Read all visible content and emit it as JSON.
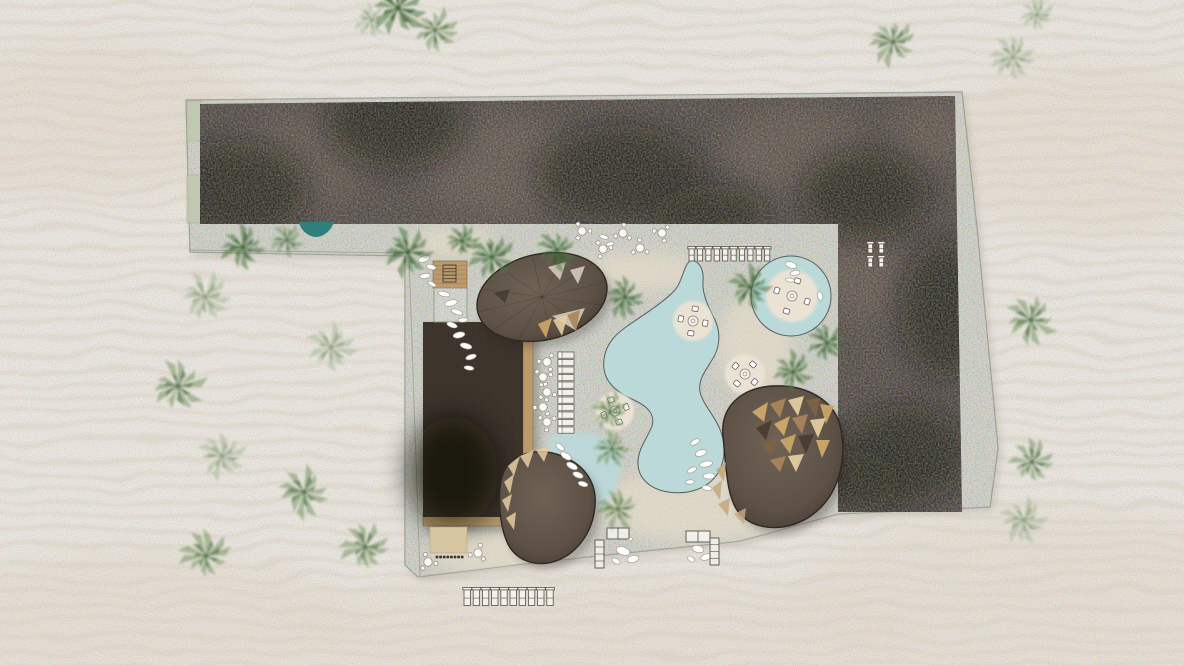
{
  "plan": {
    "canvas": {
      "w": 1184,
      "h": 666
    },
    "colors": {
      "sand": "#f3eee6",
      "sand_line": "#e4d8c6",
      "sand_shade": "#ece1d2",
      "plaza": "#d5d7c8",
      "plaza_edge": "#989c8d",
      "plaza_dune": "#eadfcb",
      "roof": "#3d342c",
      "roof_light": "#6a594a",
      "roof_black": "#0a0705",
      "pool": "#bcd9da",
      "pool_stroke": "#565f5c",
      "teal_pool": "#2f807d",
      "island": "#eae2d3",
      "white": "#ffffff",
      "furniture_stroke": "#57524b",
      "wood": "#bb9a6b",
      "wood_dark": "#8a6e4b",
      "dome": "#63564a",
      "dome_oval": "#6b5e52",
      "dome_stroke": "#2f2822",
      "tan_a": "#cfa96b",
      "tan_b": "#e3cc9f",
      "tan_c": "#a9855a",
      "tan_d": "#7c6347",
      "patch": "#d5c5a0",
      "planter": "#bfc9ae",
      "pebble": "#fdfdfb",
      "pebble_stroke": "#9a958c",
      "pale_tri": "#d3ccbd",
      "shadow": "#8d8673"
    },
    "site": {
      "outline": [
        [
          186,
          100
        ],
        [
          962,
          92
        ],
        [
          977,
          228
        ],
        [
          998,
          448
        ],
        [
          990,
          507
        ],
        [
          838,
          514
        ],
        [
          740,
          541
        ],
        [
          530,
          563
        ],
        [
          418,
          577
        ],
        [
          405,
          565
        ],
        [
          405,
          256
        ],
        [
          190,
          252
        ]
      ],
      "roof_top": [
        [
          200,
          104
        ],
        [
          955,
          96
        ],
        [
          957,
          224
        ],
        [
          200,
          224
        ]
      ],
      "roof_right": [
        [
          838,
          224
        ],
        [
          957,
          224
        ],
        [
          962,
          512
        ],
        [
          838,
          512
        ]
      ],
      "roof_dark_blobs": [
        [
          235,
          190,
          75,
          50
        ],
        [
          395,
          125,
          70,
          45
        ],
        [
          620,
          175,
          85,
          50
        ],
        [
          710,
          215,
          60,
          30
        ],
        [
          865,
          195,
          65,
          45
        ],
        [
          945,
          310,
          45,
          70
        ],
        [
          905,
          455,
          65,
          50
        ],
        [
          850,
          482,
          50,
          32
        ]
      ],
      "roof_light_patches": [
        [
          300,
          160,
          70,
          45
        ],
        [
          500,
          165,
          80,
          50
        ],
        [
          795,
          150,
          70,
          45
        ],
        [
          935,
          135,
          45,
          35
        ],
        [
          862,
          272,
          45,
          50
        ]
      ],
      "planters": [
        [
          187,
          101,
          14,
          40
        ],
        [
          187,
          175,
          16,
          48
        ]
      ],
      "inner_lines": [
        [
          [
            190,
            250
          ],
          [
            408,
            253
          ]
        ],
        [
          [
            409,
            256
          ],
          [
            420,
            576
          ]
        ]
      ],
      "plaza_dunes": [
        [
          640,
          272,
          60,
          20
        ],
        [
          755,
          345,
          38,
          48
        ],
        [
          700,
          505,
          100,
          38
        ],
        [
          505,
          552,
          75,
          26
        ],
        [
          452,
          242,
          40,
          14
        ]
      ]
    },
    "pools": {
      "freeform_path": "M 692,260 C 700,262 704,270 703,281 C 702,294 708,306 715,320 C 721,333 720,348 712,360 C 705,371 698,380 700,392 C 703,404 713,414 719,427 C 726,442 726,460 718,473 C 708,489 688,495 668,492 C 649,489 637,477 638,461 C 639,447 648,437 652,426 C 655,416 650,408 636,401 C 618,393 606,384 604,369 C 602,352 610,338 626,327 C 643,315 663,303 675,290 C 683,281 684,262 692,260 Z",
      "lagoon_path": "M 552,434 C 572,428 596,432 610,443 C 622,453 624,468 618,480 C 612,493 612,502 602,506 C 588,511 570,501 560,490 C 549,478 544,462 548,450 C 550,443 548,437 552,434 Z",
      "teal_path": "M 299,222 C 301,232 310,237 316,237 C 323,237 331,231 334,222 Z",
      "circular": {
        "cx": 791,
        "cy": 296,
        "r": 40
      }
    },
    "islands": [
      [
        693,
        321,
        20,
        10
      ],
      [
        745,
        374,
        20,
        40
      ],
      [
        615,
        411,
        19,
        70
      ],
      [
        792,
        296,
        26,
        20
      ]
    ],
    "building": {
      "x": 423,
      "y": 322,
      "w": 100,
      "h": 195,
      "wood_right": [
        523,
        322,
        10,
        195
      ],
      "wood_bottom": [
        423,
        513,
        110,
        13
      ],
      "tan_patch": [
        430,
        527,
        37,
        26
      ]
    },
    "deck": {
      "wood": [
        433,
        261,
        34,
        27
      ],
      "ladder": [
        443,
        265,
        13,
        17
      ],
      "box": [
        434,
        288,
        33,
        34
      ]
    },
    "domes": {
      "oval": {
        "cx": 542,
        "cy": 297,
        "rx": 66,
        "ry": 43,
        "rot": -13
      },
      "oval_facets": [
        {
          "pts": [
            [
              548,
              267
            ],
            [
              566,
              262
            ],
            [
              560,
              280
            ]
          ],
          "c": "pale"
        },
        {
          "pts": [
            [
              570,
              270
            ],
            [
              585,
              266
            ],
            [
              578,
              284
            ]
          ],
          "c": "pale"
        },
        {
          "pts": [
            [
              494,
              293
            ],
            [
              510,
              289
            ],
            [
              505,
              303
            ]
          ],
          "c": "dark"
        },
        {
          "pts": [
            [
              552,
              316
            ],
            [
              585,
              308
            ],
            [
              575,
              330
            ]
          ],
          "c": "pale"
        },
        {
          "pts": [
            [
              538,
              324
            ],
            [
              552,
              318
            ],
            [
              546,
              338
            ]
          ],
          "c": "tan_a"
        },
        {
          "pts": [
            [
              553,
              320
            ],
            [
              568,
              314
            ],
            [
              562,
              336
            ]
          ],
          "c": "tan_b"
        },
        {
          "pts": [
            [
              567,
              315
            ],
            [
              580,
              310
            ],
            [
              576,
              332
            ]
          ],
          "c": "tan_c"
        }
      ],
      "right_path": "M 723,436 C 720,406 742,388 772,386 C 806,384 836,400 841,430 C 847,462 838,496 812,515 C 790,531 759,532 742,516 C 726,502 726,464 723,436 Z",
      "right_mosaic": [
        [
          [
            752,
            412
          ],
          [
            768,
            402
          ],
          [
            764,
            422
          ]
        ],
        [
          [
            770,
            404
          ],
          [
            786,
            398
          ],
          [
            780,
            418
          ]
        ],
        [
          [
            788,
            400
          ],
          [
            804,
            396
          ],
          [
            798,
            416
          ]
        ],
        [
          [
            806,
            400
          ],
          [
            820,
            398
          ],
          [
            816,
            418
          ]
        ],
        [
          [
            820,
            404
          ],
          [
            834,
            406
          ],
          [
            826,
            424
          ]
        ],
        [
          [
            756,
            428
          ],
          [
            772,
            420
          ],
          [
            766,
            440
          ]
        ],
        [
          [
            774,
            424
          ],
          [
            790,
            416
          ],
          [
            784,
            436
          ]
        ],
        [
          [
            792,
            418
          ],
          [
            808,
            414
          ],
          [
            802,
            434
          ]
        ],
        [
          [
            810,
            420
          ],
          [
            826,
            418
          ],
          [
            818,
            438
          ]
        ],
        [
          [
            762,
            444
          ],
          [
            778,
            438
          ],
          [
            772,
            456
          ]
        ],
        [
          [
            780,
            440
          ],
          [
            796,
            434
          ],
          [
            790,
            454
          ]
        ],
        [
          [
            798,
            436
          ],
          [
            814,
            434
          ],
          [
            806,
            454
          ]
        ],
        [
          [
            816,
            440
          ],
          [
            830,
            440
          ],
          [
            822,
            458
          ]
        ],
        [
          [
            770,
            460
          ],
          [
            786,
            456
          ],
          [
            780,
            472
          ]
        ],
        [
          [
            788,
            456
          ],
          [
            804,
            454
          ],
          [
            796,
            472
          ]
        ]
      ],
      "right_rim": [
        [
          [
            716,
            470
          ],
          [
            726,
            462
          ],
          [
            724,
            482
          ]
        ],
        [
          [
            712,
            488
          ],
          [
            722,
            480
          ],
          [
            720,
            500
          ]
        ],
        [
          [
            718,
            504
          ],
          [
            730,
            498
          ],
          [
            728,
            516
          ]
        ],
        [
          [
            734,
            514
          ],
          [
            746,
            508
          ],
          [
            744,
            524
          ]
        ]
      ],
      "bottom_path": "M 505,469 C 515,452 540,447 562,456 C 585,465 597,483 595,506 C 593,531 578,553 556,561 C 535,568 515,560 507,542 C 499,523 496,487 505,469 Z",
      "bottom_rim": [
        [
          [
            508,
            466
          ],
          [
            520,
            456
          ],
          [
            514,
            476
          ]
        ],
        [
          [
            504,
            482
          ],
          [
            514,
            474
          ],
          [
            510,
            494
          ]
        ],
        [
          [
            502,
            500
          ],
          [
            512,
            494
          ],
          [
            508,
            512
          ]
        ],
        [
          [
            506,
            518
          ],
          [
            516,
            512
          ],
          [
            514,
            530
          ]
        ],
        [
          [
            520,
            456
          ],
          [
            534,
            450
          ],
          [
            528,
            468
          ]
        ],
        [
          [
            536,
            450
          ],
          [
            550,
            446
          ],
          [
            544,
            462
          ]
        ]
      ]
    },
    "palms": [
      [
        398,
        8,
        28,
        "d"
      ],
      [
        435,
        30,
        22,
        "m"
      ],
      [
        372,
        20,
        18,
        "p"
      ],
      [
        893,
        42,
        24,
        "m"
      ],
      [
        1013,
        57,
        22,
        "p"
      ],
      [
        1037,
        15,
        18,
        "p"
      ],
      [
        205,
        297,
        26,
        "p"
      ],
      [
        178,
        386,
        27,
        "m"
      ],
      [
        331,
        347,
        25,
        "p"
      ],
      [
        222,
        456,
        25,
        "p"
      ],
      [
        304,
        492,
        26,
        "m"
      ],
      [
        365,
        547,
        25,
        "m"
      ],
      [
        206,
        556,
        25,
        "m"
      ],
      [
        1031,
        320,
        26,
        "m"
      ],
      [
        1032,
        462,
        22,
        "m"
      ],
      [
        1024,
        520,
        24,
        "p"
      ],
      [
        243,
        247,
        23,
        "d"
      ],
      [
        287,
        240,
        17,
        "m"
      ],
      [
        408,
        252,
        25,
        "d"
      ],
      [
        462,
        241,
        17,
        "d"
      ],
      [
        492,
        257,
        23,
        "d"
      ],
      [
        557,
        250,
        21,
        "d"
      ],
      [
        625,
        297,
        21,
        "d"
      ],
      [
        750,
        287,
        22,
        "d"
      ],
      [
        793,
        372,
        21,
        "d"
      ],
      [
        827,
        343,
        19,
        "d"
      ],
      [
        610,
        412,
        20,
        "m"
      ],
      [
        612,
        449,
        19,
        "m"
      ],
      [
        618,
        509,
        21,
        "m"
      ]
    ],
    "pebbles": [
      [
        424,
        259,
        6,
        3,
        -20
      ],
      [
        431,
        267,
        5,
        2.5,
        15
      ],
      [
        425,
        276,
        5.5,
        2.5,
        -8
      ],
      [
        432,
        284,
        4.5,
        2,
        30
      ],
      [
        444,
        294,
        6,
        2.5,
        12
      ],
      [
        451,
        303,
        6.5,
        3,
        -14
      ],
      [
        457,
        312,
        6,
        2.5,
        18
      ],
      [
        463,
        320,
        5,
        2.2,
        -5
      ],
      [
        452,
        325,
        5.5,
        2.5,
        20
      ],
      [
        459,
        335,
        6,
        3,
        -12
      ],
      [
        466,
        346,
        6,
        2.8,
        15
      ],
      [
        471,
        357,
        5.5,
        2.5,
        -18
      ],
      [
        469,
        368,
        5,
        2.2,
        8
      ],
      [
        560,
        447,
        5,
        2.5,
        40
      ],
      [
        566,
        456,
        6,
        3,
        33
      ],
      [
        572,
        466,
        6,
        3,
        28
      ],
      [
        578,
        475,
        5.5,
        2.8,
        22
      ],
      [
        583,
        484,
        5,
        2.5,
        15
      ],
      [
        695,
        442,
        5,
        2.5,
        -30
      ],
      [
        701,
        453,
        6,
        3,
        -18
      ],
      [
        706,
        464,
        6.5,
        3,
        -10
      ],
      [
        709,
        476,
        6,
        3,
        -2
      ],
      [
        707,
        488,
        5,
        2.5,
        12
      ],
      [
        692,
        470,
        5,
        2.5,
        -25
      ],
      [
        690,
        482,
        4.5,
        2.2,
        -5
      ],
      [
        791,
        265,
        6,
        3,
        18
      ],
      [
        795,
        273,
        5,
        2.5,
        -12
      ],
      [
        790,
        280,
        4.5,
        2,
        8
      ],
      [
        820,
        296,
        4.5,
        2.5,
        75
      ],
      [
        604,
        237,
        4.5,
        2,
        15
      ],
      [
        610,
        244,
        4,
        2,
        -10
      ],
      [
        623,
        551,
        7,
        4,
        18
      ],
      [
        633,
        559,
        6,
        3.5,
        -14
      ],
      [
        616,
        561,
        4.5,
        2.5,
        28
      ],
      [
        629,
        539,
        3.5,
        2,
        0
      ],
      [
        698,
        549,
        6,
        3.5,
        14
      ],
      [
        706,
        557,
        5.5,
        3,
        -18
      ],
      [
        691,
        559,
        4,
        2.5,
        36
      ]
    ],
    "furniture": {
      "lounger_rows": [
        {
          "x": 689,
          "y": 248,
          "dx": 8.4,
          "n": 10,
          "w": 5.2,
          "h": 13
        },
        {
          "x": 464,
          "y": 589,
          "dx": 9.2,
          "n": 10,
          "w": 6.4,
          "h": 16.5
        },
        {
          "x": 868,
          "y": 243,
          "dx": 11,
          "n": 2,
          "w": 4.6,
          "h": 10
        },
        {
          "x": 868,
          "y": 257,
          "dx": 11,
          "n": 2,
          "w": 4.6,
          "h": 10
        }
      ],
      "lounger_col": {
        "x": 558,
        "y": 352,
        "dy": 7.5,
        "n": 11,
        "w": 16,
        "h": 6.2
      },
      "bistro": [
        [
          582,
          231
        ],
        [
          623,
          233
        ],
        [
          662,
          233
        ],
        [
          603,
          249
        ],
        [
          640,
          248
        ],
        [
          547,
          362
        ],
        [
          543,
          377
        ],
        [
          547,
          392
        ],
        [
          543,
          407
        ],
        [
          547,
          422
        ],
        [
          428,
          562
        ],
        [
          478,
          553
        ]
      ],
      "groups": [
        {
          "table": [
            607,
            528,
            22,
            11
          ],
          "lounger": [
            595,
            540,
            9,
            28
          ]
        },
        {
          "table": [
            686,
            531,
            24,
            11
          ],
          "lounger": [
            710,
            538,
            9,
            27
          ]
        }
      ],
      "dots": {
        "x": 437,
        "y": 557,
        "dx": 3.6,
        "n": 8
      }
    }
  }
}
